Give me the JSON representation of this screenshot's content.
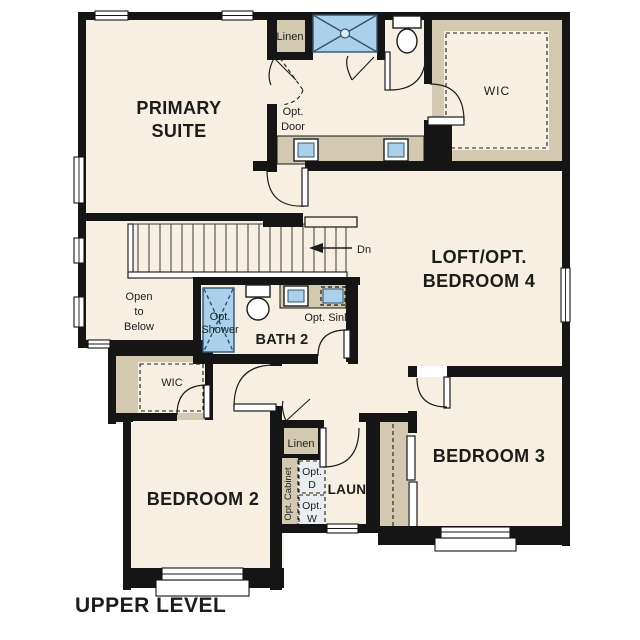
{
  "title": "UPPER LEVEL",
  "colors": {
    "floor": "#f6efe2",
    "wall": "#151515",
    "tan": "#d3c9b1",
    "blue": "#abd0ec",
    "blue_dark": "#33536e",
    "line": "#1c1c1c"
  },
  "rooms": {
    "primary_suite": {
      "line1": "PRIMARY",
      "line2": "SUITE"
    },
    "wic_primary": {
      "label": "WIC"
    },
    "loft": {
      "line1": "LOFT/OPT.",
      "line2": "BEDROOM 4"
    },
    "bath2": {
      "label": "BATH 2"
    },
    "open_to_below": {
      "line1": "Open",
      "line2": "to",
      "line3": "Below"
    },
    "wic_bedroom2": {
      "label": "WIC"
    },
    "bedroom2": {
      "label": "BEDROOM 2"
    },
    "bedroom3": {
      "label": "BEDROOM 3"
    },
    "laundry": {
      "label": "LAUN"
    }
  },
  "annotations": {
    "linen_primary": "Linen",
    "linen_hall": "Linen",
    "opt_door": {
      "line1": "Opt.",
      "line2": "Door"
    },
    "opt_shower": {
      "line1": "Opt.",
      "line2": "Shower"
    },
    "opt_sink": "Opt. Sink",
    "down": "Dn",
    "opt_cabinet": "Opt. Cabinet",
    "opt_dryer": {
      "line1": "Opt.",
      "line2": "D"
    },
    "opt_washer": {
      "line1": "Opt.",
      "line2": "W"
    }
  }
}
